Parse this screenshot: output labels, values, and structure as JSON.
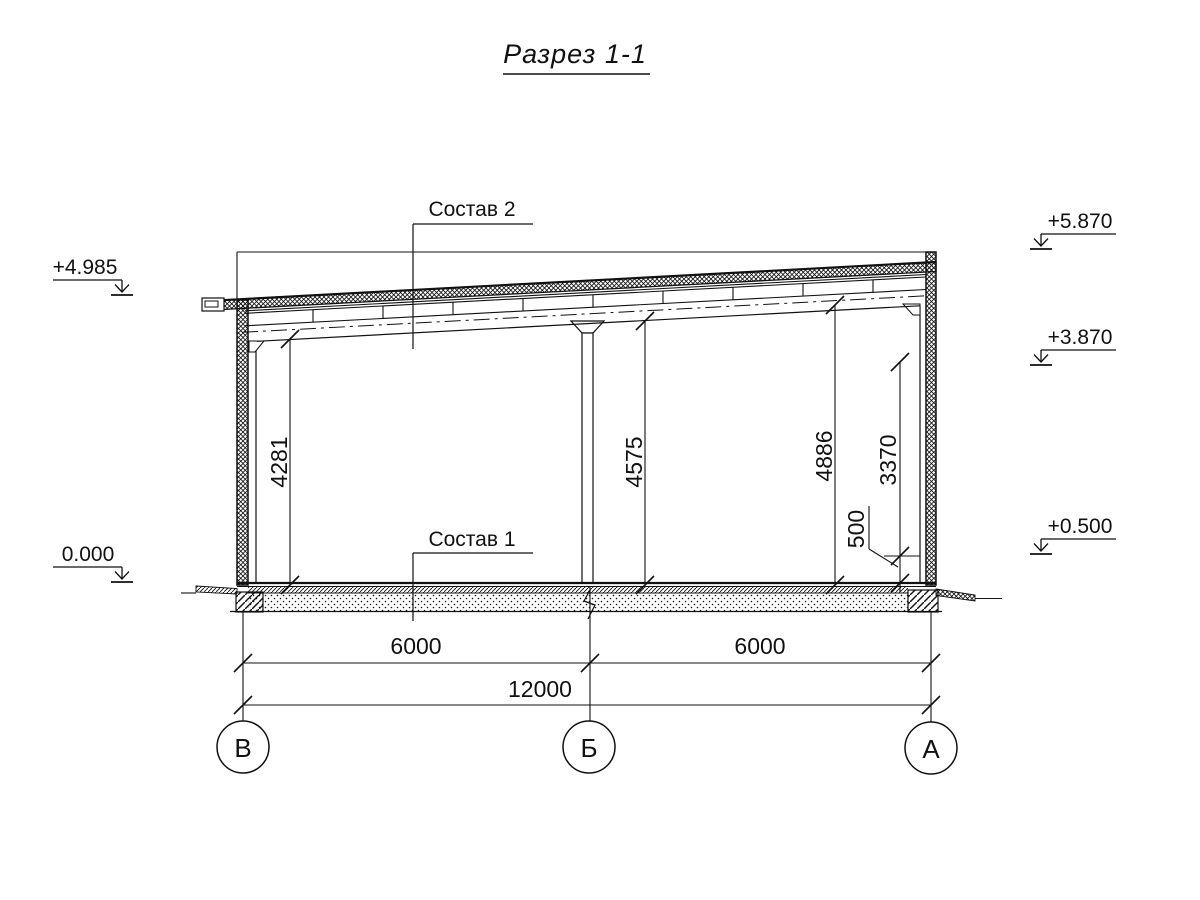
{
  "title": "Разрез 1-1",
  "callouts": {
    "roof_composition": "Состав 2",
    "floor_composition": "Состав 1"
  },
  "elevation_marks": {
    "left_roof": "+4.985",
    "left_floor": "0.000",
    "right_parapet": "+5.870",
    "right_girt": "+3.870",
    "right_plinth": "+0.500"
  },
  "vertical_dimensions": {
    "axis_v_clear": "4281",
    "axis_b_clear": "4575",
    "axis_a_clear": "4886",
    "girt_to_plinth": "3370",
    "plinth_height": "500"
  },
  "horizontal_dimensions": {
    "span_v_b": "6000",
    "span_b_a": "6000",
    "total_span": "12000"
  },
  "axis_labels": {
    "axis_v": "В",
    "axis_b": "Б",
    "axis_a": "А"
  },
  "colors": {
    "ink": "#111111",
    "background": "#ffffff"
  }
}
